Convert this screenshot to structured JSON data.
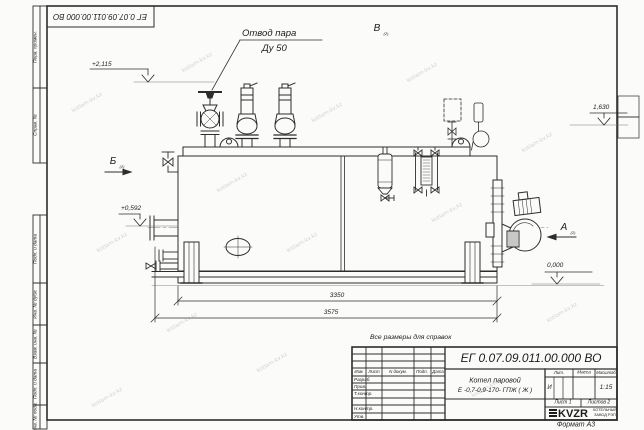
{
  "sheet": {
    "doc_number": "ЕГ 0.07.09.011.00.000  ВО",
    "format_note": "Формат А3",
    "reference_note": "Все размеры для справок",
    "watermark_text": "kotlam-kv.kz"
  },
  "margin_stamps": {
    "perv_primen": "Перв. примен.",
    "sprav_no": "Справ. №",
    "podp_data_1": "Подп. и дата",
    "inv_dubl": "Инв. № дубл.",
    "vzam_inv": "Взам. инв. №",
    "podp_data_2": "Подп. и дата",
    "inv_podl": "Инв. № подл."
  },
  "annotations": {
    "steam_outlet_line1": "Отвод пара",
    "steam_outlet_line2": "Ду 50",
    "view_a": "А",
    "view_b": "Б",
    "view_v": "В",
    "view_sheet_ref": "(2)",
    "elev_top": "+2,115",
    "elev_right": "1,630",
    "elev_mid": "+0,592",
    "elev_zero": "0,000",
    "dim_inner": "3350",
    "dim_outer": "3575"
  },
  "title_block": {
    "doc_number": "ЕГ 0.07.09.011.00.000  ВО",
    "col_izm": "Изм.",
    "col_list": "Лист",
    "col_ndoc": "N докум.",
    "col_podp": "Подп.",
    "col_data": "Дата",
    "row_razrab": "Разраб.",
    "row_prov": "Пров.",
    "row_tkontr": "Т.контр.",
    "row_nkontr": "Н.контр.",
    "row_utv": "Утв.",
    "product_name_line1": "Котел паровой",
    "product_name_line2": "Е -0,7-0,9-170- ГПЖ ( Ж )",
    "lit_header": "Лит.",
    "mass_header": "Масса",
    "scale_header": "Масштаб",
    "lit_value": "И",
    "scale_value": "1:15",
    "sheet_no": "Лист 1",
    "sheets_total": "Листов 2",
    "logo_text": "KVZR",
    "logo_sub1": "КОТЕЛЬНЫЙ",
    "logo_sub2": "ЗАВОД РЭП"
  }
}
